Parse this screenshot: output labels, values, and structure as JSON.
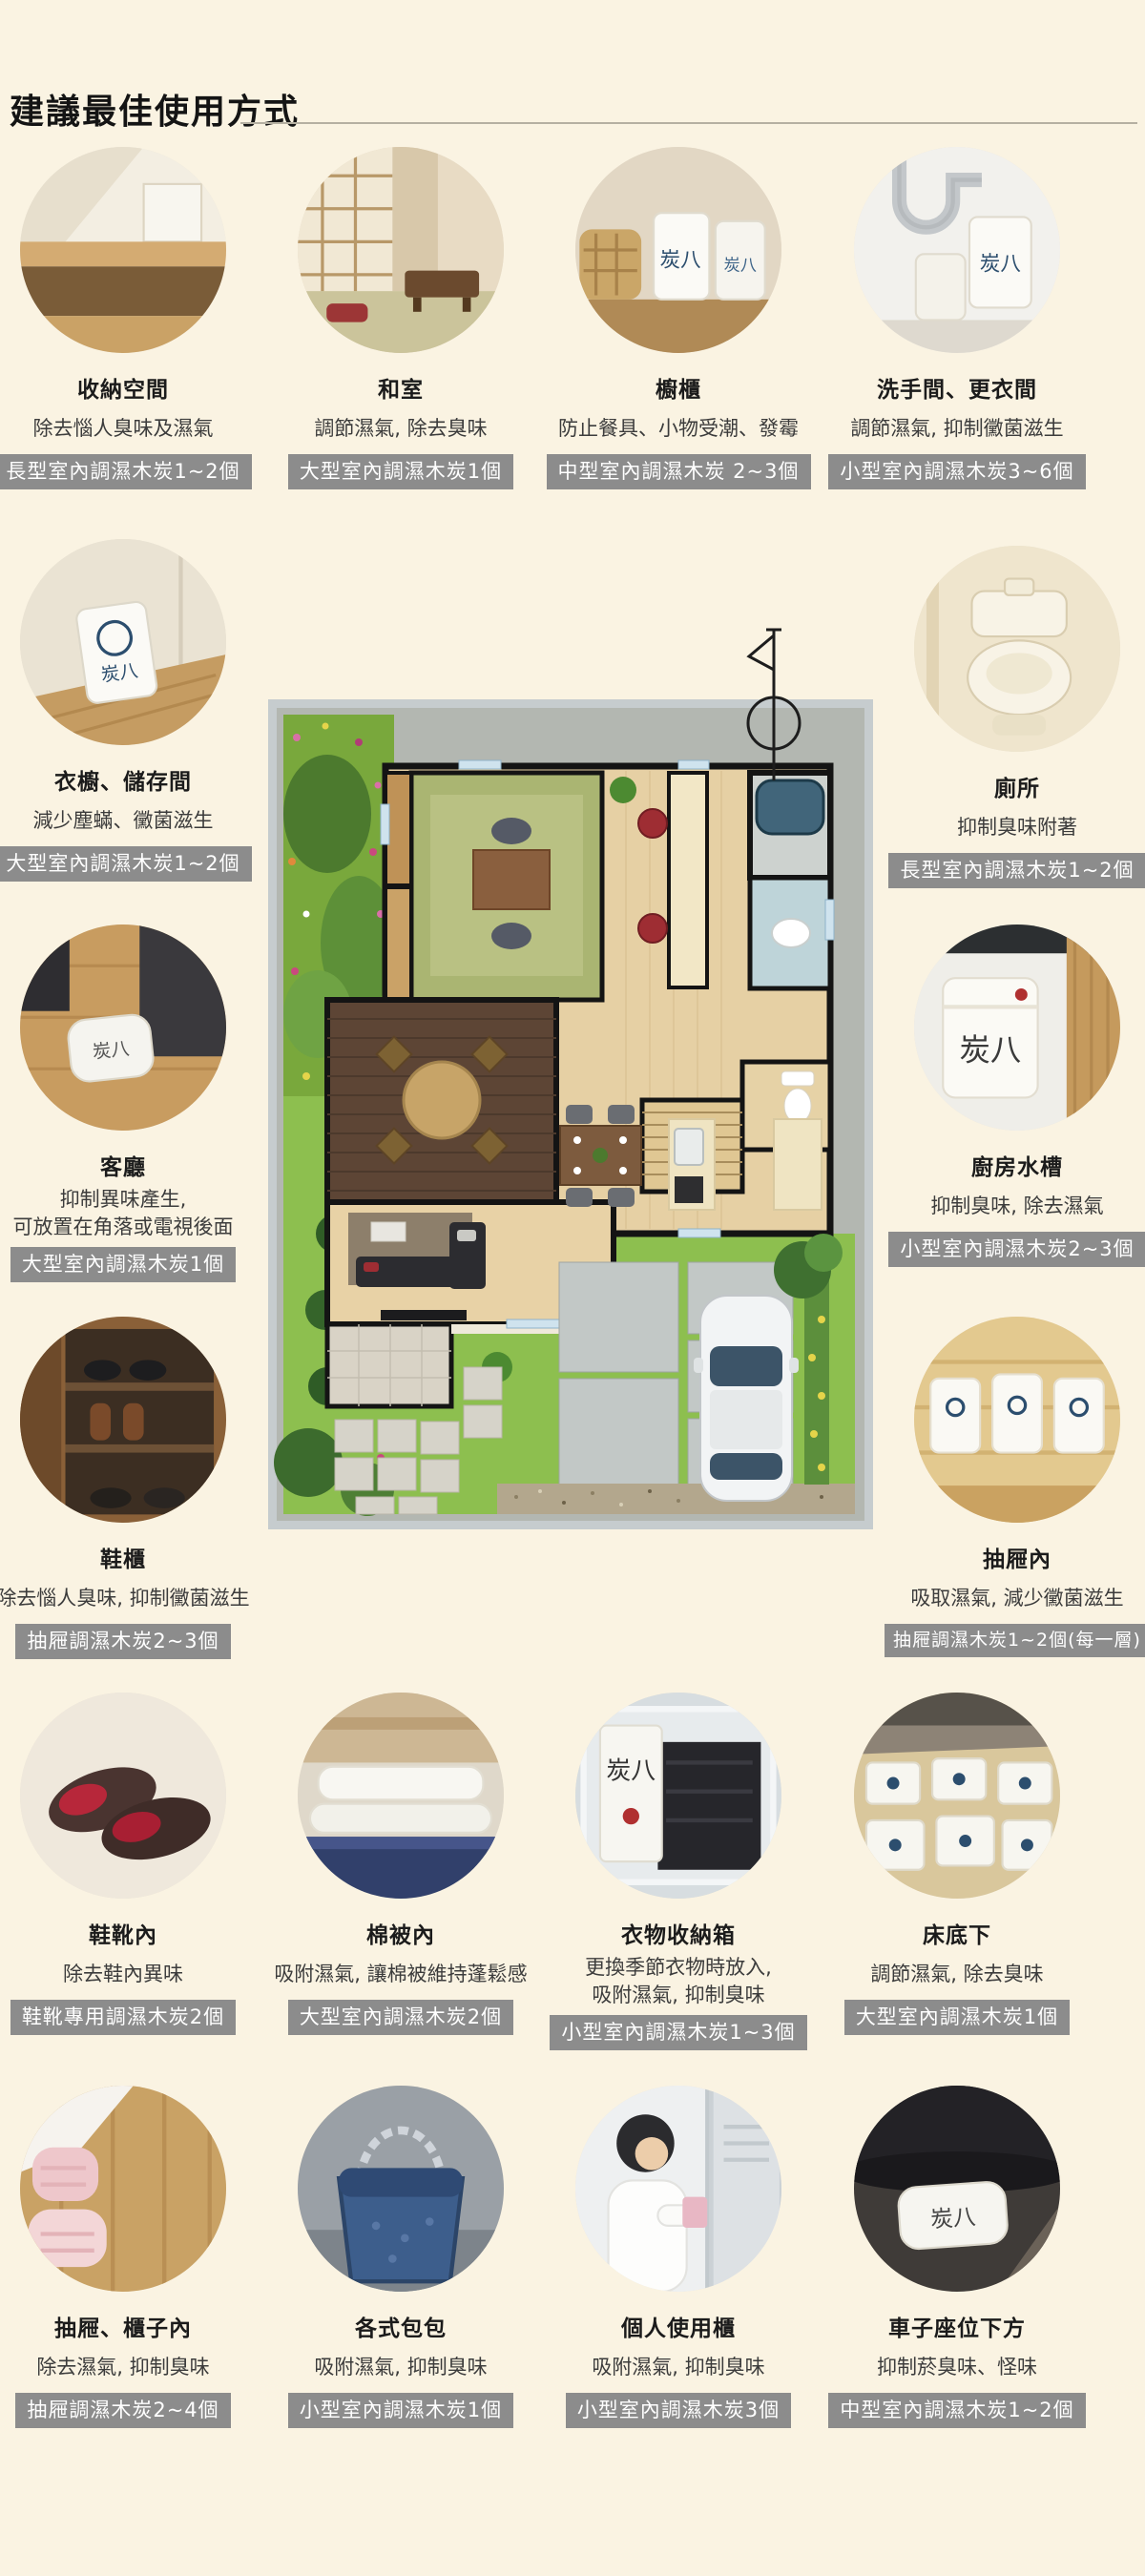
{
  "page": {
    "title": "建議最佳使用方式",
    "background": "#faf3e2",
    "badge_bg": "#8c8c8c",
    "badge_fg": "#ffffff"
  },
  "brand": {
    "bag_label": "炭八"
  },
  "items": [
    {
      "id": "storage-space",
      "title": "收納空間",
      "desc1": "除去惱人臭味及濕氣",
      "badge": "長型室內調濕木炭1~2個"
    },
    {
      "id": "washitsu",
      "title": "和室",
      "desc1": "調節濕氣, 除去臭味",
      "badge": "大型室內調濕木炭1個"
    },
    {
      "id": "cupboard",
      "title": "櫥櫃",
      "desc1": "防止餐具、小物受潮、發霉",
      "badge": "中型室內調濕木炭 2~3個"
    },
    {
      "id": "washroom",
      "title": "洗手間、更衣間",
      "desc1": "調節濕氣, 抑制黴菌滋生",
      "badge": "小型室內調濕木炭3~6個"
    },
    {
      "id": "wardrobe",
      "title": "衣櫥、儲存間",
      "desc1": "減少塵蟎、黴菌滋生",
      "badge": "大型室內調濕木炭1~2個"
    },
    {
      "id": "toilet",
      "title": "廁所",
      "desc1": "抑制臭味附著",
      "badge": "長型室內調濕木炭1~2個"
    },
    {
      "id": "living-room",
      "title": "客廳",
      "desc1": "抑制異味產生,",
      "desc2": "可放置在角落或電視後面",
      "badge": "大型室內調濕木炭1個"
    },
    {
      "id": "kitchen-sink",
      "title": "廚房水槽",
      "desc1": "抑制臭味, 除去濕氣",
      "badge": "小型室內調濕木炭2~3個"
    },
    {
      "id": "shoe-cabinet",
      "title": "鞋櫃",
      "desc1": "除去惱人臭味, 抑制黴菌滋生",
      "badge": "抽屜調濕木炭2~3個"
    },
    {
      "id": "drawer",
      "title": "抽屜內",
      "desc1": "吸取濕氣, 減少黴菌滋生",
      "badge": "抽屜調濕木炭1~2個(每一層)"
    },
    {
      "id": "shoes",
      "title": "鞋靴內",
      "desc1": "除去鞋內異味",
      "badge": "鞋靴專用調濕木炭2個"
    },
    {
      "id": "futon",
      "title": "棉被內",
      "desc1": "吸附濕氣, 讓棉被維持蓬鬆感",
      "badge": "大型室內調濕木炭2個"
    },
    {
      "id": "clothes-box",
      "title": "衣物收納箱",
      "desc1": "更換季節衣物時放入,",
      "desc2": "吸附濕氣, 抑制臭味",
      "badge": "小型室內調濕木炭1~3個"
    },
    {
      "id": "under-bed",
      "title": "床底下",
      "desc1": "調節濕氣, 除去臭味",
      "badge": "大型室內調濕木炭1個"
    },
    {
      "id": "drawer-cabinet",
      "title": "抽屜、櫃子內",
      "desc1": "除去濕氣, 抑制臭味",
      "badge": "抽屜調濕木炭2~4個"
    },
    {
      "id": "bags",
      "title": "各式包包",
      "desc1": "吸附濕氣, 抑制臭味",
      "badge": "小型室內調濕木炭1個"
    },
    {
      "id": "locker",
      "title": "個人使用櫃",
      "desc1": "吸附濕氣, 抑制臭味",
      "badge": "小型室內調濕木炭3個"
    },
    {
      "id": "car-seat",
      "title": "車子座位下方",
      "desc1": "抑制菸臭味、怪味",
      "badge": "中型室內調濕木炭1~2個"
    }
  ]
}
